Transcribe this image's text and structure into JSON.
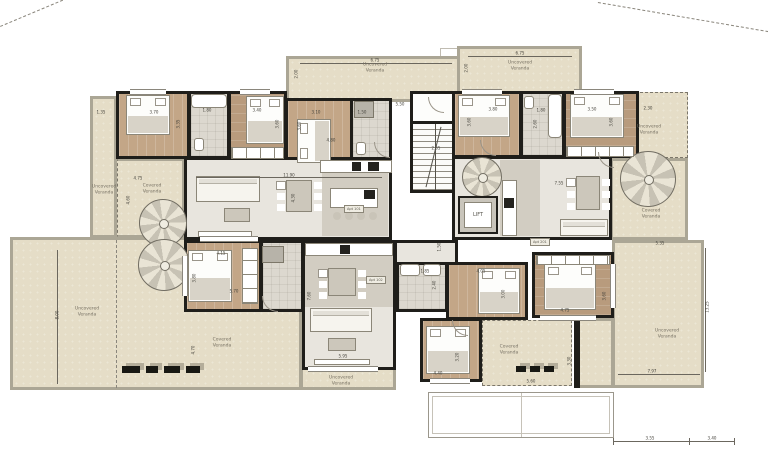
{
  "plan": {
    "type": "architectural-floor-plan",
    "units": "meters",
    "labels": {
      "lift": "LIFT",
      "uncovered_veranda": "Uncovered Veranda",
      "covered_veranda": "Covered Veranda"
    }
  },
  "colors": {
    "veranda": "#e5ddc7",
    "wood_floor": "#c3a687",
    "tile_floor": "#dcd8cf",
    "interior": "#e8e5de",
    "wall": "#1f1e1a",
    "dim_text": "#45433c",
    "label_text": "#767062"
  },
  "apartments": [
    {
      "id": "apt-1",
      "label": "Apt 101",
      "x": 344,
      "y": 205
    },
    {
      "id": "apt-2",
      "label": "Apt 102",
      "x": 366,
      "y": 276
    },
    {
      "id": "apt-3",
      "label": "Apt 201",
      "x": 530,
      "y": 238
    }
  ],
  "room_labels": [
    {
      "t": "Uncovered Veranda",
      "x": 375,
      "y": 68
    },
    {
      "t": "Uncovered Veranda",
      "x": 520,
      "y": 66
    },
    {
      "t": "Uncovered Veranda",
      "x": 649,
      "y": 130
    },
    {
      "t": "Covered Veranda",
      "x": 651,
      "y": 214
    },
    {
      "t": "Uncovered Veranda",
      "x": 104,
      "y": 190
    },
    {
      "t": "Covered Veranda",
      "x": 152,
      "y": 189
    },
    {
      "t": "Uncovered Veranda",
      "x": 87,
      "y": 312
    },
    {
      "t": "Covered Veranda",
      "x": 222,
      "y": 343
    },
    {
      "t": "Uncovered Veranda",
      "x": 341,
      "y": 381
    },
    {
      "t": "Covered Veranda",
      "x": 509,
      "y": 350
    },
    {
      "t": "Uncovered Veranda",
      "x": 667,
      "y": 334
    }
  ],
  "dimensions": [
    {
      "v": "6.75",
      "x": 375,
      "y": 60
    },
    {
      "v": "2.00",
      "x": 296,
      "y": 74,
      "rot": "v"
    },
    {
      "v": "6.75",
      "x": 520,
      "y": 53
    },
    {
      "v": "2.00",
      "x": 466,
      "y": 68,
      "rot": "v"
    },
    {
      "v": "1.35",
      "x": 101,
      "y": 112
    },
    {
      "v": "3.70",
      "x": 154,
      "y": 112
    },
    {
      "v": "3.35",
      "x": 178,
      "y": 124,
      "rot": "v"
    },
    {
      "v": "1.80",
      "x": 207,
      "y": 110
    },
    {
      "v": "3.40",
      "x": 257,
      "y": 110
    },
    {
      "v": "3.60",
      "x": 277,
      "y": 124,
      "rot": "v"
    },
    {
      "v": "3.10",
      "x": 316,
      "y": 112
    },
    {
      "v": "3.60",
      "x": 299,
      "y": 126,
      "rot": "v"
    },
    {
      "v": "1.50",
      "x": 362,
      "y": 112
    },
    {
      "v": "4.80",
      "x": 331,
      "y": 140
    },
    {
      "v": "5.50",
      "x": 400,
      "y": 104
    },
    {
      "v": "11.90",
      "x": 289,
      "y": 175
    },
    {
      "v": "4.30",
      "x": 293,
      "y": 198,
      "rot": "v"
    },
    {
      "v": "2.65",
      "x": 436,
      "y": 148
    },
    {
      "v": "3.80",
      "x": 493,
      "y": 109
    },
    {
      "v": "3.60",
      "x": 469,
      "y": 122,
      "rot": "v"
    },
    {
      "v": "1.80",
      "x": 541,
      "y": 110
    },
    {
      "v": "2.60",
      "x": 535,
      "y": 124,
      "rot": "v"
    },
    {
      "v": "3.50",
      "x": 592,
      "y": 109
    },
    {
      "v": "3.60",
      "x": 611,
      "y": 122,
      "rot": "v"
    },
    {
      "v": "2.30",
      "x": 648,
      "y": 108
    },
    {
      "v": "4.75",
      "x": 138,
      "y": 178
    },
    {
      "v": "4.60",
      "x": 128,
      "y": 200,
      "rot": "v"
    },
    {
      "v": "8.00",
      "x": 57,
      "y": 315,
      "rot": "v"
    },
    {
      "v": "4.70",
      "x": 193,
      "y": 350,
      "rot": "v"
    },
    {
      "v": "4.15",
      "x": 221,
      "y": 253
    },
    {
      "v": "3.80",
      "x": 194,
      "y": 278,
      "rot": "v"
    },
    {
      "v": "5.70",
      "x": 234,
      "y": 291
    },
    {
      "v": "7.60",
      "x": 309,
      "y": 296,
      "rot": "v"
    },
    {
      "v": "5.95",
      "x": 343,
      "y": 356
    },
    {
      "v": "7.55",
      "x": 559,
      "y": 183
    },
    {
      "v": "1.85",
      "x": 425,
      "y": 271
    },
    {
      "v": "2.40",
      "x": 434,
      "y": 285,
      "rot": "v"
    },
    {
      "v": "4.05",
      "x": 481,
      "y": 271
    },
    {
      "v": "3.00",
      "x": 503,
      "y": 294,
      "rot": "v"
    },
    {
      "v": "1.50",
      "x": 439,
      "y": 247,
      "rot": "v"
    },
    {
      "v": "4.75",
      "x": 565,
      "y": 310
    },
    {
      "v": "3.60",
      "x": 604,
      "y": 296,
      "rot": "v"
    },
    {
      "v": "3.20",
      "x": 457,
      "y": 357,
      "rot": "v"
    },
    {
      "v": "4.40",
      "x": 438,
      "y": 373
    },
    {
      "v": "5.60",
      "x": 531,
      "y": 381
    },
    {
      "v": "3.30",
      "x": 569,
      "y": 361,
      "rot": "v"
    },
    {
      "v": "5.35",
      "x": 660,
      "y": 243
    },
    {
      "v": "13.25",
      "x": 707,
      "y": 307,
      "rot": "v"
    },
    {
      "v": "7.97",
      "x": 652,
      "y": 371
    },
    {
      "v": "3.55",
      "x": 650,
      "y": 438
    },
    {
      "v": "3.40",
      "x": 712,
      "y": 438
    }
  ]
}
